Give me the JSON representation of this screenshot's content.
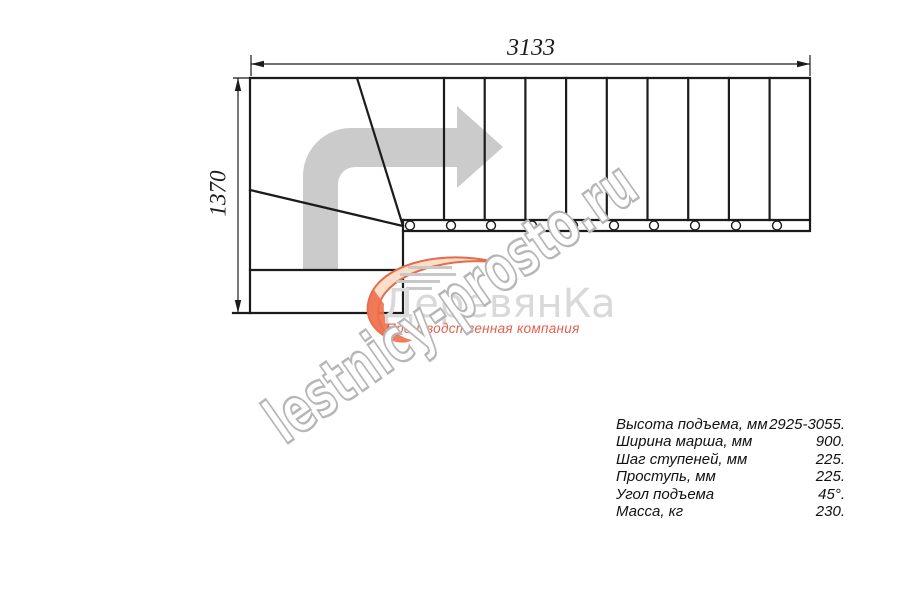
{
  "dimensions": {
    "width_mm": "3133",
    "height_mm": "1370"
  },
  "watermark": {
    "text": "lestnicy-prosto.ru"
  },
  "logo": {
    "company": "ДеревянКа",
    "tagline": "Производственная компания",
    "accent_color": "#e2614b",
    "gray_color": "#d9d9d9"
  },
  "specs": [
    {
      "label": "Высота подъема, мм",
      "value": "2925-3055."
    },
    {
      "label": "Ширина марша, мм",
      "value": "900."
    },
    {
      "label": "Шаг ступеней, мм",
      "value": "225."
    },
    {
      "label": "Проступь, мм",
      "value": "225."
    },
    {
      "label": "Угол подъема",
      "value": "45°."
    },
    {
      "label": "Масса, кг",
      "value": "230."
    }
  ],
  "colors": {
    "drawing_line": "#1b1b1b",
    "direction_arrow": "#cbcbcb",
    "watermark_outline": "#b6b6b6",
    "background": "#ffffff"
  }
}
